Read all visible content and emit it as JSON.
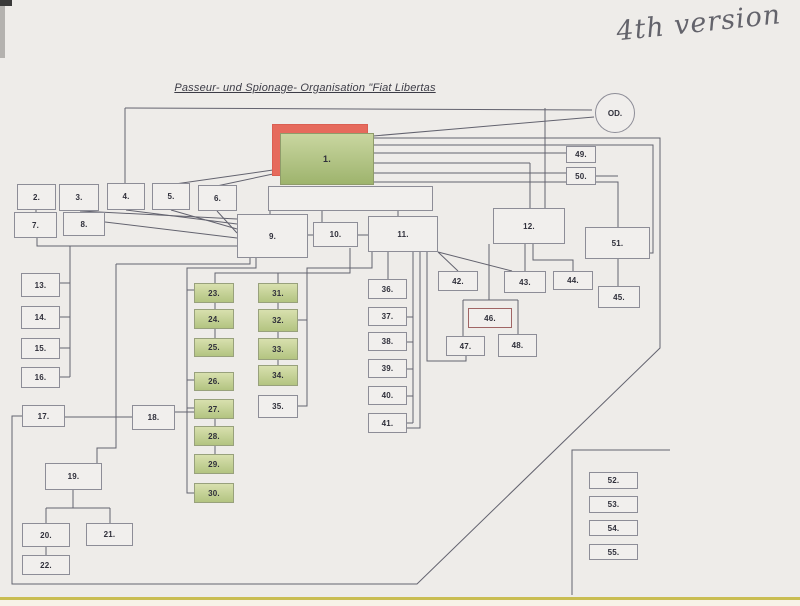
{
  "page": {
    "title": "Passeur- und Spionage- Organisation \"Fiat Libertas",
    "handwritten_note": "4th version",
    "od_circle_label": "OD."
  },
  "colors": {
    "paper": "#eeece9",
    "line": "#63636f",
    "box_border": "#8d8d97",
    "box_fill": "#f1efed",
    "green_top": "#d8e0ae",
    "green_bottom": "#b3c481",
    "red_highlight": "#e66a5c"
  },
  "boxes": [
    {
      "id": "red-shadow",
      "label": "",
      "x": 272,
      "y": 124,
      "w": 96,
      "h": 52,
      "variant": "red"
    },
    {
      "id": "1",
      "label": "1.",
      "x": 280,
      "y": 133,
      "w": 94,
      "h": 52,
      "variant": "green-large"
    },
    {
      "id": "untitled-wide",
      "label": "",
      "x": 268,
      "y": 186,
      "w": 165,
      "h": 25,
      "variant": "plain"
    },
    {
      "id": "2",
      "label": "2.",
      "x": 17,
      "y": 184,
      "w": 39,
      "h": 26,
      "variant": "plain"
    },
    {
      "id": "3",
      "label": "3.",
      "x": 59,
      "y": 184,
      "w": 40,
      "h": 27,
      "variant": "plain"
    },
    {
      "id": "4",
      "label": "4.",
      "x": 107,
      "y": 183,
      "w": 38,
      "h": 27,
      "variant": "plain"
    },
    {
      "id": "5",
      "label": "5.",
      "x": 152,
      "y": 183,
      "w": 38,
      "h": 27,
      "variant": "plain"
    },
    {
      "id": "6",
      "label": "6.",
      "x": 198,
      "y": 185,
      "w": 39,
      "h": 26,
      "variant": "plain"
    },
    {
      "id": "7",
      "label": "7.",
      "x": 14,
      "y": 212,
      "w": 43,
      "h": 26,
      "variant": "plain"
    },
    {
      "id": "8",
      "label": "8.",
      "x": 63,
      "y": 212,
      "w": 42,
      "h": 24,
      "variant": "plain"
    },
    {
      "id": "9",
      "label": "9.",
      "x": 237,
      "y": 214,
      "w": 71,
      "h": 44,
      "variant": "plain"
    },
    {
      "id": "10",
      "label": "10.",
      "x": 313,
      "y": 222,
      "w": 45,
      "h": 25,
      "variant": "plain"
    },
    {
      "id": "11",
      "label": "11.",
      "x": 368,
      "y": 216,
      "w": 70,
      "h": 36,
      "variant": "plain"
    },
    {
      "id": "12",
      "label": "12.",
      "x": 493,
      "y": 208,
      "w": 72,
      "h": 36,
      "variant": "plain"
    },
    {
      "id": "13",
      "label": "13.",
      "x": 21,
      "y": 273,
      "w": 39,
      "h": 24,
      "variant": "plain"
    },
    {
      "id": "14",
      "label": "14.",
      "x": 21,
      "y": 306,
      "w": 39,
      "h": 23,
      "variant": "plain"
    },
    {
      "id": "15",
      "label": "15.",
      "x": 21,
      "y": 338,
      "w": 39,
      "h": 21,
      "variant": "plain"
    },
    {
      "id": "16",
      "label": "16.",
      "x": 21,
      "y": 367,
      "w": 39,
      "h": 21,
      "variant": "plain"
    },
    {
      "id": "17",
      "label": "17.",
      "x": 22,
      "y": 405,
      "w": 43,
      "h": 22,
      "variant": "plain"
    },
    {
      "id": "18",
      "label": "18.",
      "x": 132,
      "y": 405,
      "w": 43,
      "h": 25,
      "variant": "plain"
    },
    {
      "id": "19",
      "label": "19.",
      "x": 45,
      "y": 463,
      "w": 57,
      "h": 27,
      "variant": "plain"
    },
    {
      "id": "20",
      "label": "20.",
      "x": 22,
      "y": 523,
      "w": 48,
      "h": 24,
      "variant": "plain"
    },
    {
      "id": "21",
      "label": "21.",
      "x": 86,
      "y": 523,
      "w": 47,
      "h": 23,
      "variant": "plain"
    },
    {
      "id": "22",
      "label": "22.",
      "x": 22,
      "y": 555,
      "w": 48,
      "h": 20,
      "variant": "plain"
    },
    {
      "id": "23",
      "label": "23.",
      "x": 194,
      "y": 283,
      "w": 40,
      "h": 20,
      "variant": "green"
    },
    {
      "id": "24",
      "label": "24.",
      "x": 194,
      "y": 309,
      "w": 40,
      "h": 20,
      "variant": "green"
    },
    {
      "id": "25",
      "label": "25.",
      "x": 194,
      "y": 338,
      "w": 40,
      "h": 19,
      "variant": "green"
    },
    {
      "id": "26",
      "label": "26.",
      "x": 194,
      "y": 372,
      "w": 40,
      "h": 19,
      "variant": "green"
    },
    {
      "id": "27",
      "label": "27.",
      "x": 194,
      "y": 399,
      "w": 40,
      "h": 20,
      "variant": "green"
    },
    {
      "id": "28",
      "label": "28.",
      "x": 194,
      "y": 426,
      "w": 40,
      "h": 20,
      "variant": "green"
    },
    {
      "id": "29",
      "label": "29.",
      "x": 194,
      "y": 454,
      "w": 40,
      "h": 20,
      "variant": "green"
    },
    {
      "id": "30",
      "label": "30.",
      "x": 194,
      "y": 483,
      "w": 40,
      "h": 20,
      "variant": "green"
    },
    {
      "id": "31",
      "label": "31.",
      "x": 258,
      "y": 283,
      "w": 40,
      "h": 20,
      "variant": "green"
    },
    {
      "id": "32",
      "label": "32.",
      "x": 258,
      "y": 309,
      "w": 40,
      "h": 23,
      "variant": "green"
    },
    {
      "id": "33",
      "label": "33.",
      "x": 258,
      "y": 338,
      "w": 40,
      "h": 22,
      "variant": "green"
    },
    {
      "id": "34",
      "label": "34.",
      "x": 258,
      "y": 365,
      "w": 40,
      "h": 21,
      "variant": "green"
    },
    {
      "id": "35",
      "label": "35.",
      "x": 258,
      "y": 395,
      "w": 40,
      "h": 23,
      "variant": "plain"
    },
    {
      "id": "36",
      "label": "36.",
      "x": 368,
      "y": 279,
      "w": 39,
      "h": 20,
      "variant": "plain"
    },
    {
      "id": "37",
      "label": "37.",
      "x": 368,
      "y": 307,
      "w": 39,
      "h": 19,
      "variant": "plain"
    },
    {
      "id": "38",
      "label": "38.",
      "x": 368,
      "y": 332,
      "w": 39,
      "h": 19,
      "variant": "plain"
    },
    {
      "id": "39",
      "label": "39.",
      "x": 368,
      "y": 359,
      "w": 39,
      "h": 19,
      "variant": "plain"
    },
    {
      "id": "40",
      "label": "40.",
      "x": 368,
      "y": 386,
      "w": 39,
      "h": 19,
      "variant": "plain"
    },
    {
      "id": "41",
      "label": "41.",
      "x": 368,
      "y": 413,
      "w": 39,
      "h": 20,
      "variant": "plain"
    },
    {
      "id": "42",
      "label": "42.",
      "x": 438,
      "y": 271,
      "w": 40,
      "h": 20,
      "variant": "plain"
    },
    {
      "id": "43",
      "label": "43.",
      "x": 504,
      "y": 271,
      "w": 42,
      "h": 22,
      "variant": "plain"
    },
    {
      "id": "44",
      "label": "44.",
      "x": 553,
      "y": 271,
      "w": 40,
      "h": 19,
      "variant": "plain"
    },
    {
      "id": "45",
      "label": "45.",
      "x": 598,
      "y": 286,
      "w": 42,
      "h": 22,
      "variant": "plain"
    },
    {
      "id": "46",
      "label": "46.",
      "x": 468,
      "y": 308,
      "w": 44,
      "h": 20,
      "variant": "red-border"
    },
    {
      "id": "47",
      "label": "47.",
      "x": 446,
      "y": 336,
      "w": 39,
      "h": 20,
      "variant": "plain"
    },
    {
      "id": "48",
      "label": "48.",
      "x": 498,
      "y": 334,
      "w": 39,
      "h": 23,
      "variant": "plain"
    },
    {
      "id": "49",
      "label": "49.",
      "x": 566,
      "y": 146,
      "w": 30,
      "h": 17,
      "variant": "plain"
    },
    {
      "id": "50",
      "label": "50.",
      "x": 566,
      "y": 167,
      "w": 30,
      "h": 18,
      "variant": "plain"
    },
    {
      "id": "51",
      "label": "51.",
      "x": 585,
      "y": 227,
      "w": 65,
      "h": 32,
      "variant": "plain"
    },
    {
      "id": "52",
      "label": "52.",
      "x": 589,
      "y": 472,
      "w": 49,
      "h": 17,
      "variant": "plain"
    },
    {
      "id": "53",
      "label": "53.",
      "x": 589,
      "y": 496,
      "w": 49,
      "h": 17,
      "variant": "plain"
    },
    {
      "id": "54",
      "label": "54.",
      "x": 589,
      "y": 520,
      "w": 49,
      "h": 16,
      "variant": "plain"
    },
    {
      "id": "55",
      "label": "55.",
      "x": 589,
      "y": 544,
      "w": 49,
      "h": 16,
      "variant": "plain"
    }
  ],
  "connections": [
    [
      [
        125,
        108
      ],
      [
        592,
        110
      ]
    ],
    [
      [
        125,
        108
      ],
      [
        125,
        183
      ]
    ],
    [
      [
        545,
        108
      ],
      [
        545,
        208
      ]
    ],
    [
      [
        373,
        136
      ],
      [
        594,
        117
      ]
    ],
    [
      [
        373,
        138
      ],
      [
        660,
        138
      ],
      [
        660,
        348
      ],
      [
        417,
        584
      ],
      [
        12,
        584
      ],
      [
        12,
        416
      ],
      [
        22,
        416
      ]
    ],
    [
      [
        373,
        145
      ],
      [
        653,
        145
      ],
      [
        653,
        253
      ],
      [
        650,
        253
      ]
    ],
    [
      [
        373,
        153
      ],
      [
        566,
        153
      ]
    ],
    [
      [
        373,
        163
      ],
      [
        530,
        163
      ]
    ],
    [
      [
        530,
        163
      ],
      [
        530,
        208
      ]
    ],
    [
      [
        373,
        173
      ],
      [
        566,
        173
      ]
    ],
    [
      [
        373,
        182
      ],
      [
        618,
        182
      ],
      [
        618,
        227
      ]
    ],
    [
      [
        596,
        176
      ],
      [
        618,
        176
      ]
    ],
    [
      [
        168,
        185
      ],
      [
        273,
        170
      ]
    ],
    [
      [
        212,
        187
      ],
      [
        273,
        174
      ]
    ],
    [
      [
        80,
        211
      ],
      [
        237,
        219
      ]
    ],
    [
      [
        126,
        210
      ],
      [
        237,
        224
      ]
    ],
    [
      [
        171,
        210
      ],
      [
        237,
        229
      ]
    ],
    [
      [
        217,
        211
      ],
      [
        237,
        233
      ]
    ],
    [
      [
        105,
        222
      ],
      [
        237,
        238
      ]
    ],
    [
      [
        36,
        210
      ],
      [
        36,
        213
      ]
    ],
    [
      [
        37,
        238
      ],
      [
        37,
        246
      ],
      [
        237,
        246
      ]
    ],
    [
      [
        70,
        246
      ],
      [
        70,
        377
      ]
    ],
    [
      [
        60,
        283
      ],
      [
        70,
        283
      ]
    ],
    [
      [
        60,
        317
      ],
      [
        70,
        317
      ]
    ],
    [
      [
        60,
        348
      ],
      [
        70,
        348
      ]
    ],
    [
      [
        60,
        377
      ],
      [
        70,
        377
      ]
    ],
    [
      [
        308,
        235
      ],
      [
        313,
        235
      ]
    ],
    [
      [
        358,
        235
      ],
      [
        368,
        235
      ]
    ],
    [
      [
        270,
        211
      ],
      [
        270,
        215
      ]
    ],
    [
      [
        322,
        211
      ],
      [
        322,
        222
      ]
    ],
    [
      [
        398,
        211
      ],
      [
        398,
        216
      ]
    ],
    [
      [
        250,
        258
      ],
      [
        250,
        264
      ],
      [
        116,
        264
      ]
    ],
    [
      [
        116,
        264
      ],
      [
        116,
        448
      ],
      [
        97,
        448
      ],
      [
        97,
        463
      ]
    ],
    [
      [
        256,
        258
      ],
      [
        256,
        268
      ],
      [
        187,
        268
      ],
      [
        187,
        493
      ],
      [
        194,
        493
      ]
    ],
    [
      [
        187,
        290
      ],
      [
        194,
        290
      ]
    ],
    [
      [
        187,
        380
      ],
      [
        194,
        380
      ]
    ],
    [
      [
        187,
        408
      ],
      [
        194,
        408
      ]
    ],
    [
      [
        215,
        283
      ],
      [
        215,
        273
      ],
      [
        350,
        273
      ],
      [
        350,
        248
      ]
    ],
    [
      [
        278,
        283
      ],
      [
        278,
        273
      ]
    ],
    [
      [
        215,
        303
      ],
      [
        215,
        309
      ]
    ],
    [
      [
        215,
        329
      ],
      [
        215,
        338
      ]
    ],
    [
      [
        215,
        419
      ],
      [
        215,
        426
      ]
    ],
    [
      [
        215,
        446
      ],
      [
        215,
        454
      ]
    ],
    [
      [
        278,
        303
      ],
      [
        278,
        309
      ]
    ],
    [
      [
        278,
        332
      ],
      [
        278,
        338
      ]
    ],
    [
      [
        278,
        360
      ],
      [
        278,
        365
      ]
    ],
    [
      [
        372,
        252
      ],
      [
        372,
        268
      ],
      [
        307,
        268
      ],
      [
        307,
        406
      ],
      [
        298,
        406
      ]
    ],
    [
      [
        298,
        320
      ],
      [
        307,
        320
      ]
    ],
    [
      [
        388,
        252
      ],
      [
        388,
        279
      ]
    ],
    [
      [
        413,
        252
      ],
      [
        413,
        423
      ]
    ],
    [
      [
        407,
        317
      ],
      [
        413,
        317
      ]
    ],
    [
      [
        407,
        342
      ],
      [
        413,
        342
      ]
    ],
    [
      [
        407,
        369
      ],
      [
        413,
        369
      ]
    ],
    [
      [
        407,
        396
      ],
      [
        413,
        396
      ]
    ],
    [
      [
        407,
        423
      ],
      [
        413,
        423
      ]
    ],
    [
      [
        420,
        252
      ],
      [
        420,
        428
      ],
      [
        407,
        428
      ]
    ],
    [
      [
        427,
        252
      ],
      [
        427,
        361
      ],
      [
        466,
        361
      ],
      [
        466,
        356
      ]
    ],
    [
      [
        438,
        252
      ],
      [
        458,
        271
      ]
    ],
    [
      [
        438,
        252
      ],
      [
        512,
        271
      ]
    ],
    [
      [
        525,
        244
      ],
      [
        525,
        271
      ]
    ],
    [
      [
        533,
        244
      ],
      [
        533,
        260
      ],
      [
        573,
        260
      ],
      [
        573,
        271
      ]
    ],
    [
      [
        618,
        259
      ],
      [
        618,
        286
      ]
    ],
    [
      [
        489,
        244
      ],
      [
        489,
        300
      ]
    ],
    [
      [
        463,
        300
      ],
      [
        518,
        300
      ]
    ],
    [
      [
        463,
        300
      ],
      [
        463,
        336
      ]
    ],
    [
      [
        518,
        300
      ],
      [
        518,
        334
      ]
    ],
    [
      [
        65,
        417
      ],
      [
        132,
        417
      ]
    ],
    [
      [
        175,
        412
      ],
      [
        194,
        412
      ]
    ],
    [
      [
        73,
        490
      ],
      [
        73,
        508
      ]
    ],
    [
      [
        46,
        508
      ],
      [
        110,
        508
      ]
    ],
    [
      [
        46,
        508
      ],
      [
        46,
        523
      ]
    ],
    [
      [
        110,
        508
      ],
      [
        110,
        523
      ]
    ],
    [
      [
        46,
        547
      ],
      [
        46,
        555
      ]
    ],
    [
      [
        572,
        595
      ],
      [
        572,
        450
      ],
      [
        670,
        450
      ]
    ]
  ]
}
